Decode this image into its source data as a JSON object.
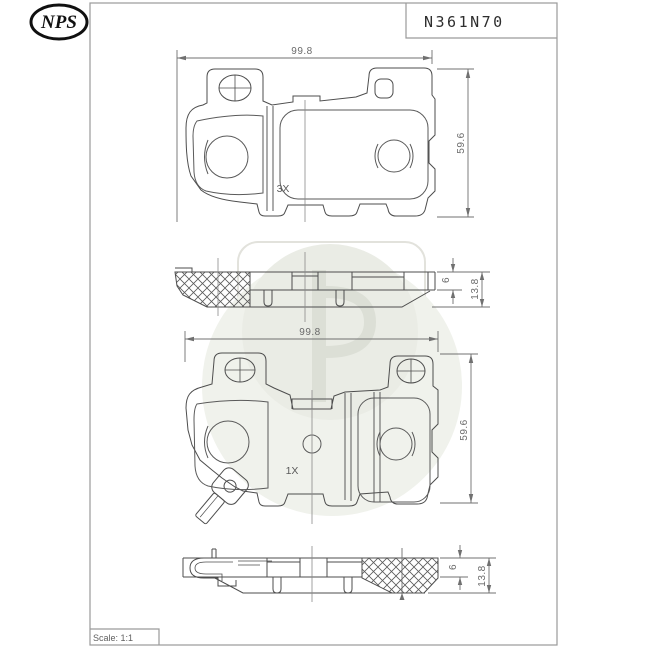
{
  "document": {
    "type": "technical-drawing",
    "part_number": "N361N70",
    "scale_label": "Scale: 1:1"
  },
  "logo": {
    "text": "NPS"
  },
  "watermark": {
    "icon": "nps-logo-watermark"
  },
  "colors": {
    "background": "#ffffff",
    "frame_line": "#9a9a9a",
    "part_line": "#4d4d4d",
    "dim_line": "#707070",
    "dim_text": "#6a6a6a",
    "watermark_fill": "#edefe9",
    "watermark_glyph": "#dcdfd6"
  },
  "views": {
    "pad_top": {
      "width_dim": "99.8",
      "height_dim": "59.6",
      "qty": "3X"
    },
    "profile_top": {
      "plate_thickness": "6",
      "total_thickness": "13.8"
    },
    "pad_bottom": {
      "width_dim": "99.8",
      "height_dim": "59.6",
      "qty": "1X"
    },
    "profile_bottom": {
      "plate_thickness": "6",
      "total_thickness": "13.8"
    }
  }
}
